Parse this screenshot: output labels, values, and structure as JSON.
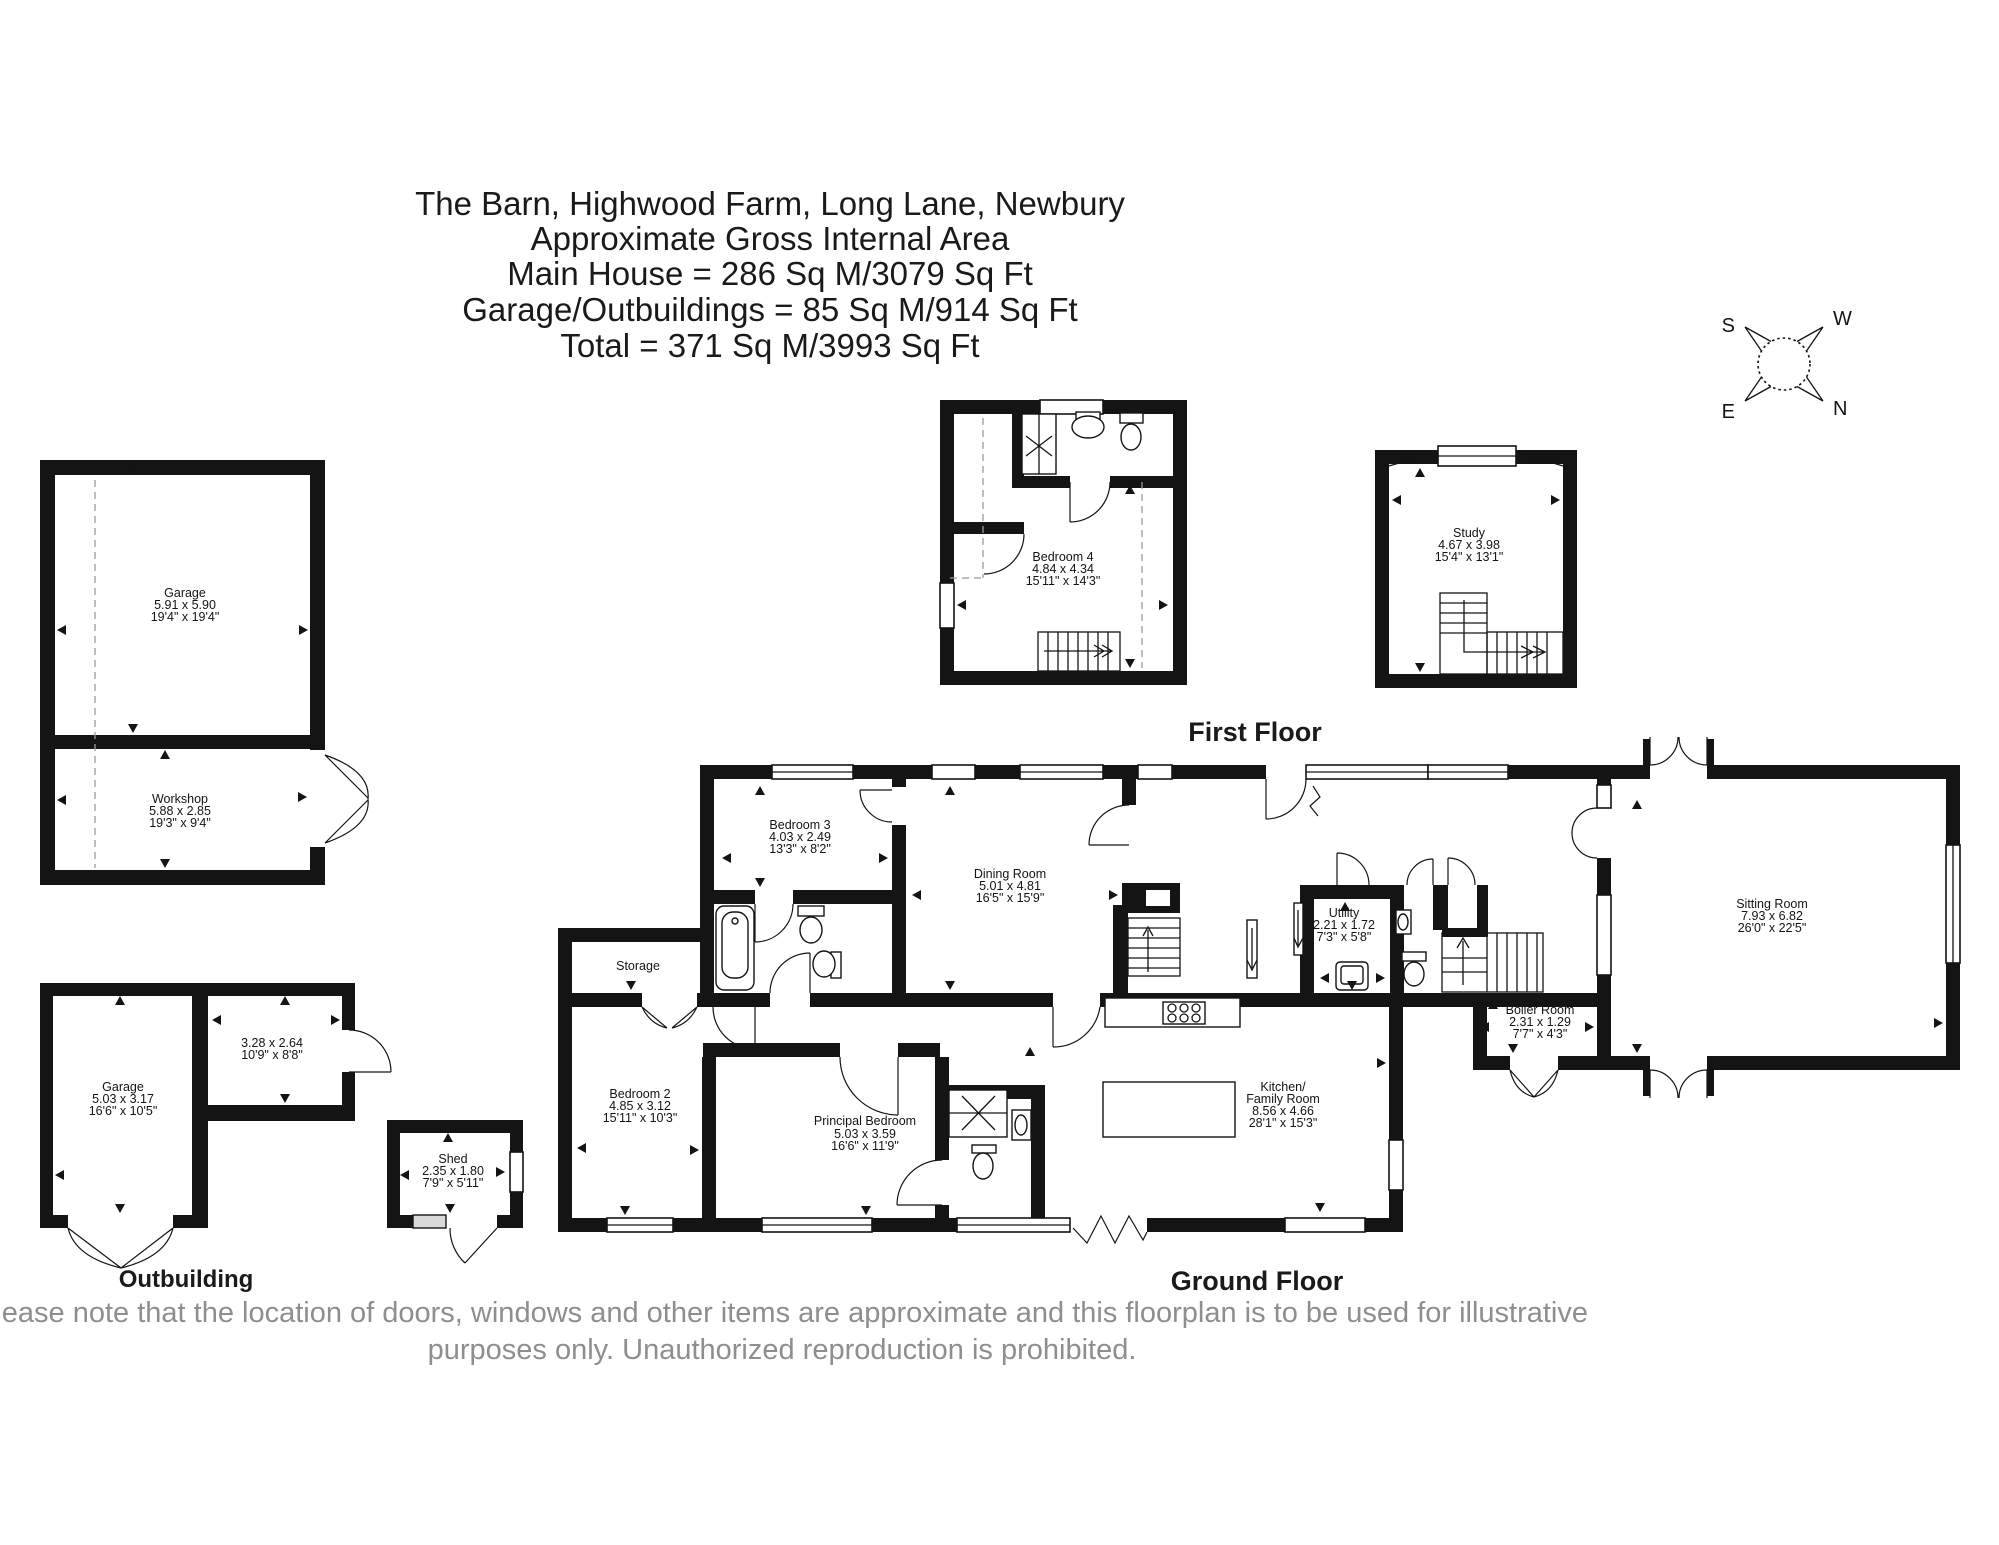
{
  "title": {
    "line1": "The Barn, Highwood Farm, Long Lane, Newbury",
    "line2": "Approximate Gross Internal Area",
    "line3": "Main House = 286 Sq M/3079 Sq Ft",
    "line4": "Garage/Outbuildings = 85 Sq M/914 Sq Ft",
    "line5": "Total = 371 Sq M/3993 Sq Ft"
  },
  "compass": {
    "n": "N",
    "s": "S",
    "e": "E",
    "w": "W"
  },
  "sections": {
    "first_floor": "First Floor",
    "ground_floor": "Ground Floor",
    "outbuilding": "Outbuilding"
  },
  "rooms": {
    "bedroom4": {
      "name": "Bedroom 4",
      "metric": "4.84 x 4.34",
      "imperial": "15'11\" x 14'3\""
    },
    "study": {
      "name": "Study",
      "metric": "4.67 x 3.98",
      "imperial": "15'4\" x 13'1\""
    },
    "garage_top": {
      "name": "Garage",
      "metric": "5.91 x 5.90",
      "imperial": "19'4\" x 19'4\""
    },
    "workshop": {
      "name": "Workshop",
      "metric": "5.88 x 2.85",
      "imperial": "19'3\" x 9'4\""
    },
    "garage_low": {
      "name": "Garage",
      "metric": "5.03 x 3.17",
      "imperial": "16'6\" x 10'5\""
    },
    "store": {
      "metric": "3.28 x 2.64",
      "imperial": "10'9\" x 8'8\""
    },
    "shed": {
      "name": "Shed",
      "metric": "2.35 x 1.80",
      "imperial": "7'9\" x 5'11\""
    },
    "bedroom3": {
      "name": "Bedroom 3",
      "metric": "4.03 x 2.49",
      "imperial": "13'3\" x 8'2\""
    },
    "storage": {
      "name": "Storage"
    },
    "dining": {
      "name": "Dining Room",
      "metric": "5.01 x 4.81",
      "imperial": "16'5\" x 15'9\""
    },
    "utility": {
      "name": "Utility",
      "metric": "2.21 x 1.72",
      "imperial": "7'3\" x 5'8\""
    },
    "boiler": {
      "name": "Boiler Room",
      "metric": "2.31 x 1.29",
      "imperial": "7'7\" x 4'3\""
    },
    "sitting": {
      "name": "Sitting Room",
      "metric": "7.93 x 6.82",
      "imperial": "26'0\" x 22'5\""
    },
    "kitchen": {
      "name1": "Kitchen/",
      "name2": "Family Room",
      "metric": "8.56 x 4.66",
      "imperial": "28'1\" x 15'3\""
    },
    "principal": {
      "name": "Principal Bedroom",
      "metric": "5.03 x 3.59",
      "imperial": "16'6\" x 11'9\""
    },
    "bedroom2": {
      "name": "Bedroom 2",
      "metric": "4.85 x 3.12",
      "imperial": "15'11\" x 10'3\""
    }
  },
  "footer": {
    "line1": "Please note that the location of doors, windows and other items are approximate and this floorplan is to be used for illustrative",
    "line2": "purposes only. Unauthorized reproduction is prohibited."
  }
}
